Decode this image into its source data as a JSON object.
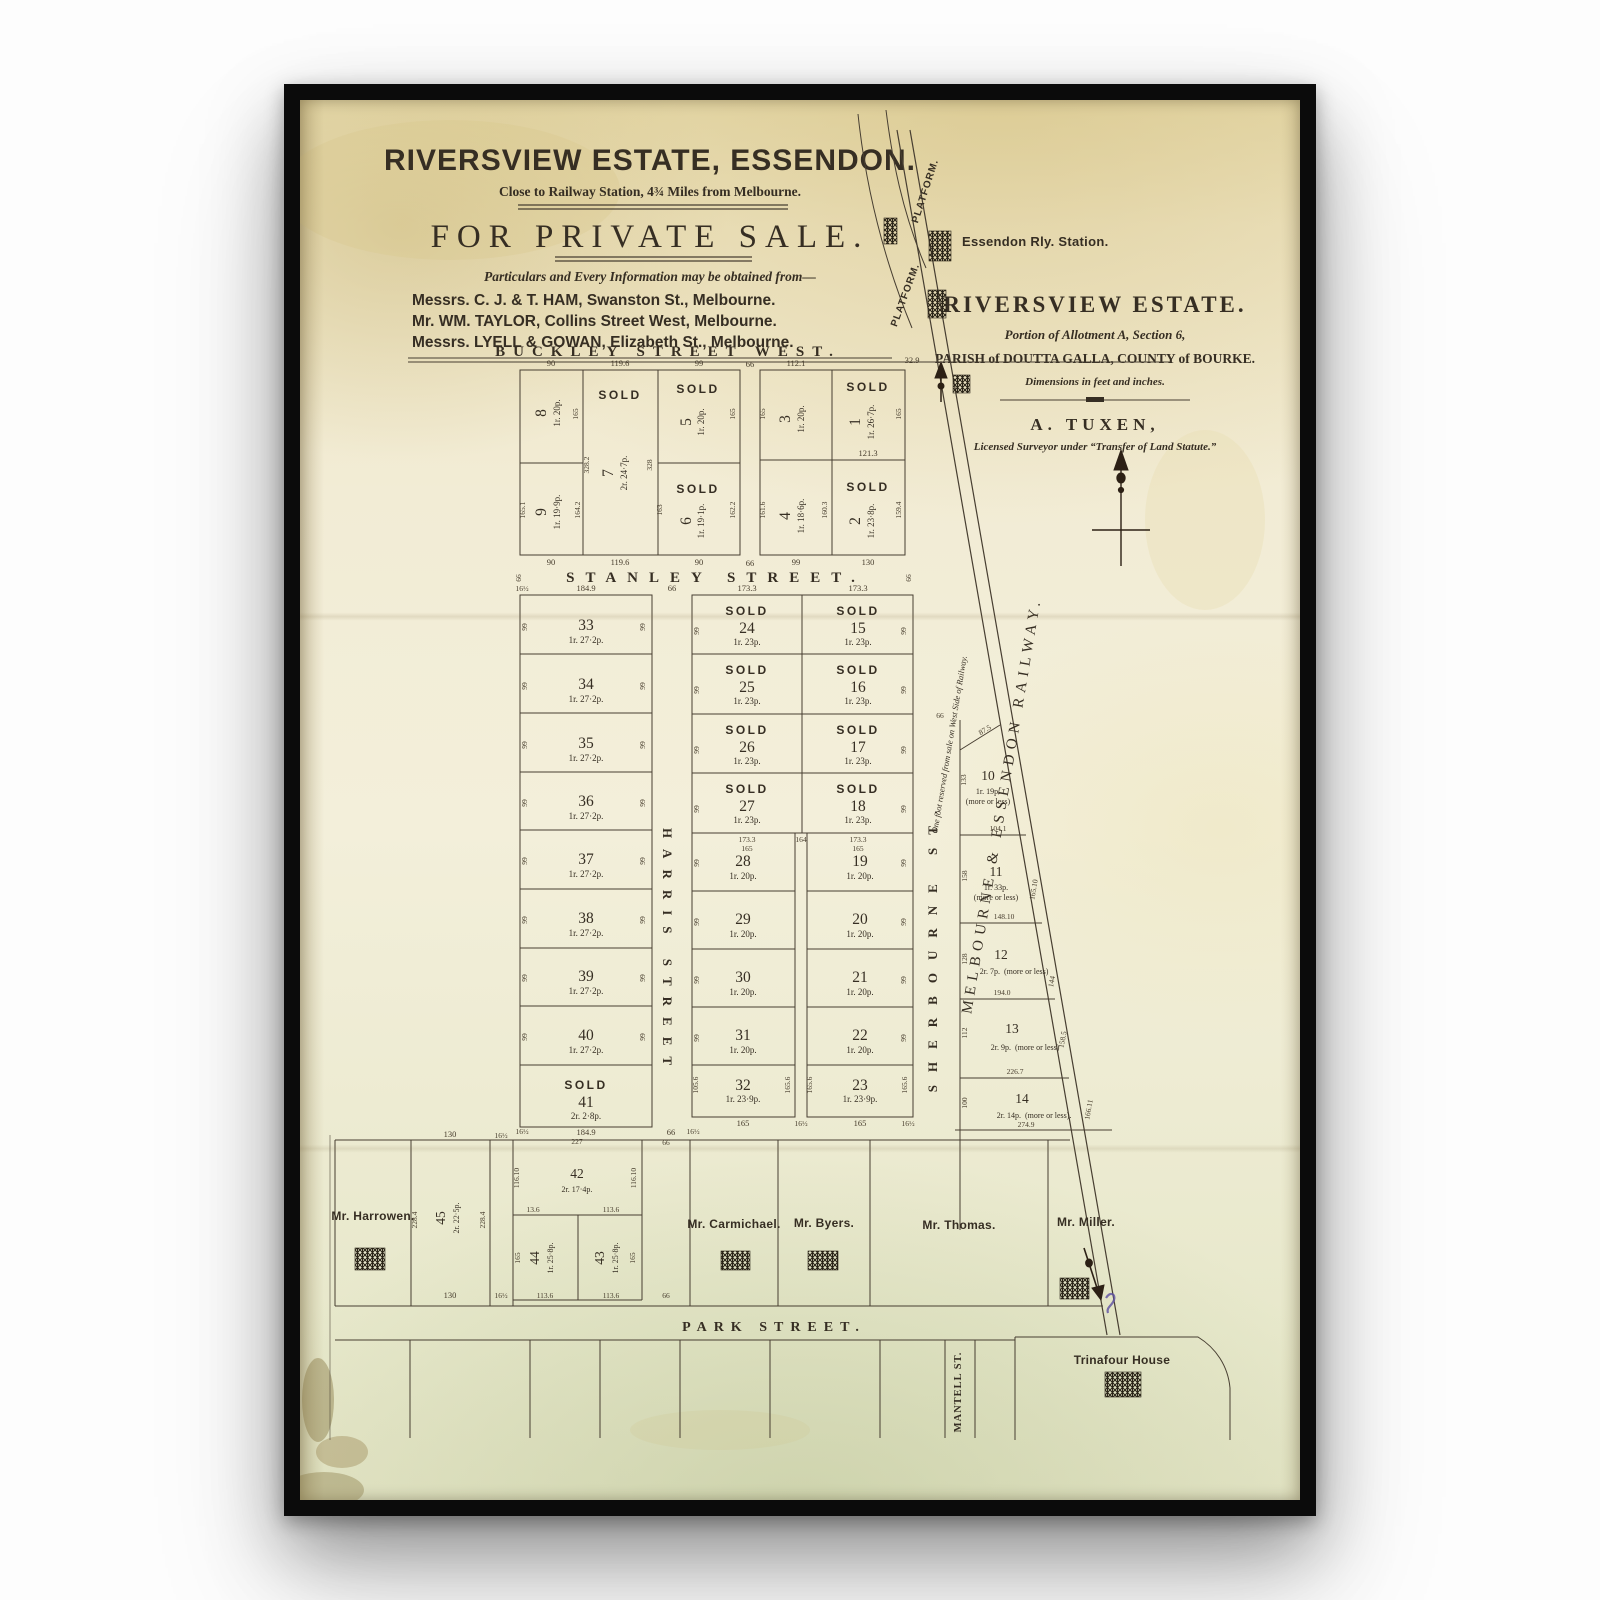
{
  "header": {
    "title": "RIVERSVIEW ESTATE, ESSENDON.",
    "subtitle": "Close to Railway Station, 4¾ Miles from Melbourne.",
    "sale_heading": "FOR PRIVATE SALE.",
    "info_line": "Particulars and Every Information may be obtained from—",
    "agents": [
      "Messrs. C. J. & T. HAM, Swanston St., Melbourne.",
      "Mr. WM. TAYLOR, Collins Street West, Melbourne.",
      "Messrs. LYELL & GOWAN, Elizabeth St., Melbourne."
    ]
  },
  "estate_panel": {
    "heading": "RIVERSVIEW ESTATE.",
    "line1": "Portion of Allotment A, Section 6,",
    "line2": "PARISH of DOUTTA GALLA, COUNTY of BOURKE.",
    "line3": "Dimensions in feet and inches.",
    "surveyor": "A. TUXEN,",
    "surveyor_note": "Licensed Surveyor under “Transfer of Land Statute.”"
  },
  "railway": {
    "platform": "PLATFORM.",
    "station": "Essendon Rly. Station.",
    "name": "MELBOURNE & ESSENDON RAILWAY.",
    "note": "One foot reserved from sale on West Side of Railway."
  },
  "streets": {
    "buckley": "BUCKLEY STREET WEST.",
    "stanley": "STANLEY STREET.",
    "harris": "HARRIS STREET",
    "sherbourne": "SHERBOURNE ST.",
    "park": "PARK STREET.",
    "mantell": "MANTELL ST."
  },
  "owners": {
    "harrowen": "Mr. Harrowen.",
    "carmichael": "Mr. Carmichael.",
    "byers": "Mr. Byers.",
    "thomas": "Mr. Thomas.",
    "miller": "Mr. Miller.",
    "trinafour": "Trinafour House"
  },
  "labels": {
    "sold": "SOLD",
    "more_or_less": "(more or less)",
    "more_or_less_dot": "(more or less)."
  },
  "lots": {
    "1": {
      "no": "1",
      "area": "1r. 26·7p."
    },
    "2": {
      "no": "2",
      "area": "1r. 23·8p."
    },
    "3": {
      "no": "3",
      "area": "1r. 20p."
    },
    "4": {
      "no": "4",
      "area": "1r. 18·6p."
    },
    "5": {
      "no": "5",
      "area": "1r. 20p."
    },
    "6": {
      "no": "6",
      "area": "1r. 19·1p."
    },
    "7": {
      "no": "7",
      "area": "2r. 24·7p."
    },
    "8": {
      "no": "8",
      "area": "1r. 20p."
    },
    "9": {
      "no": "9",
      "area": "1r. 19·9p."
    },
    "10": {
      "no": "10",
      "area": "1r. 19p."
    },
    "11": {
      "no": "11",
      "area": "1r. 33p."
    },
    "12": {
      "no": "12",
      "area": "2r. 7p."
    },
    "13": {
      "no": "13",
      "area": "2r. 9p."
    },
    "14": {
      "no": "14",
      "area": "2r. 14p."
    },
    "15": {
      "no": "15",
      "area": "1r. 23p."
    },
    "16": {
      "no": "16",
      "area": "1r. 23p."
    },
    "17": {
      "no": "17",
      "area": "1r. 23p."
    },
    "18": {
      "no": "18",
      "area": "1r. 23p."
    },
    "19": {
      "no": "19",
      "area": "1r. 20p."
    },
    "20": {
      "no": "20",
      "area": "1r. 20p."
    },
    "21": {
      "no": "21",
      "area": "1r. 20p."
    },
    "22": {
      "no": "22",
      "area": "1r. 20p."
    },
    "23": {
      "no": "23",
      "area": "1r. 23·9p."
    },
    "24": {
      "no": "24",
      "area": "1r. 23p."
    },
    "25": {
      "no": "25",
      "area": "1r. 23p."
    },
    "26": {
      "no": "26",
      "area": "1r. 23p."
    },
    "27": {
      "no": "27",
      "area": "1r. 23p."
    },
    "28": {
      "no": "28",
      "area": "1r. 20p."
    },
    "29": {
      "no": "29",
      "area": "1r. 20p."
    },
    "30": {
      "no": "30",
      "area": "1r. 20p."
    },
    "31": {
      "no": "31",
      "area": "1r. 20p."
    },
    "32": {
      "no": "32",
      "area": "1r. 23·9p."
    },
    "33": {
      "no": "33",
      "area": "1r. 27·2p."
    },
    "34": {
      "no": "34",
      "area": "1r. 27·2p."
    },
    "35": {
      "no": "35",
      "area": "1r. 27·2p."
    },
    "36": {
      "no": "36",
      "area": "1r. 27·2p."
    },
    "37": {
      "no": "37",
      "area": "1r. 27·2p."
    },
    "38": {
      "no": "38",
      "area": "1r. 27·2p."
    },
    "39": {
      "no": "39",
      "area": "1r. 27·2p."
    },
    "40": {
      "no": "40",
      "area": "1r. 27·2p."
    },
    "41": {
      "no": "41",
      "area": "2r. 2·8p."
    },
    "42": {
      "no": "42",
      "area": "2r. 17·4p."
    },
    "43": {
      "no": "43",
      "area": "1r. 25·8p."
    },
    "44": {
      "no": "44",
      "area": "1r. 25·8p."
    },
    "45": {
      "no": "45",
      "area": "2r. 22·5p."
    }
  },
  "dims": {
    "d90": "90",
    "d119_6": "119.6",
    "d99": "99",
    "d66": "66",
    "d112_1": "112.1",
    "d32_9": "32.9",
    "d130": "130",
    "d121_3": "121.3",
    "d165": "165",
    "d328_2": "328.2",
    "d328": "328",
    "d165_1": "165.1",
    "d164_2": "164.2",
    "d163": "163",
    "d162_2": "162.2",
    "d161_6": "161.6",
    "d160_3": "160.3",
    "d159_4": "159.4",
    "d184_9": "184.9",
    "d16h": "16½",
    "d173_3": "173.3",
    "d164": "164",
    "d165_6": "165.6",
    "d105_6": "105.6",
    "d87_5": "87.5",
    "d104_1": "104.1",
    "d148_10": "148.10",
    "d194_0": "194.0",
    "d226_7": "226.7",
    "d274_9": "274.9",
    "d165_10": "165.10",
    "d144": "144",
    "d158_5": "158.5",
    "d166_11": "166.11",
    "d112": "112",
    "d100": "100",
    "d133": "133",
    "d158": "158",
    "d128": "128",
    "d228_4": "228.4",
    "d227": "227",
    "d116_10": "116.10",
    "d13_6": "13.6",
    "d113_6": "113.6"
  }
}
